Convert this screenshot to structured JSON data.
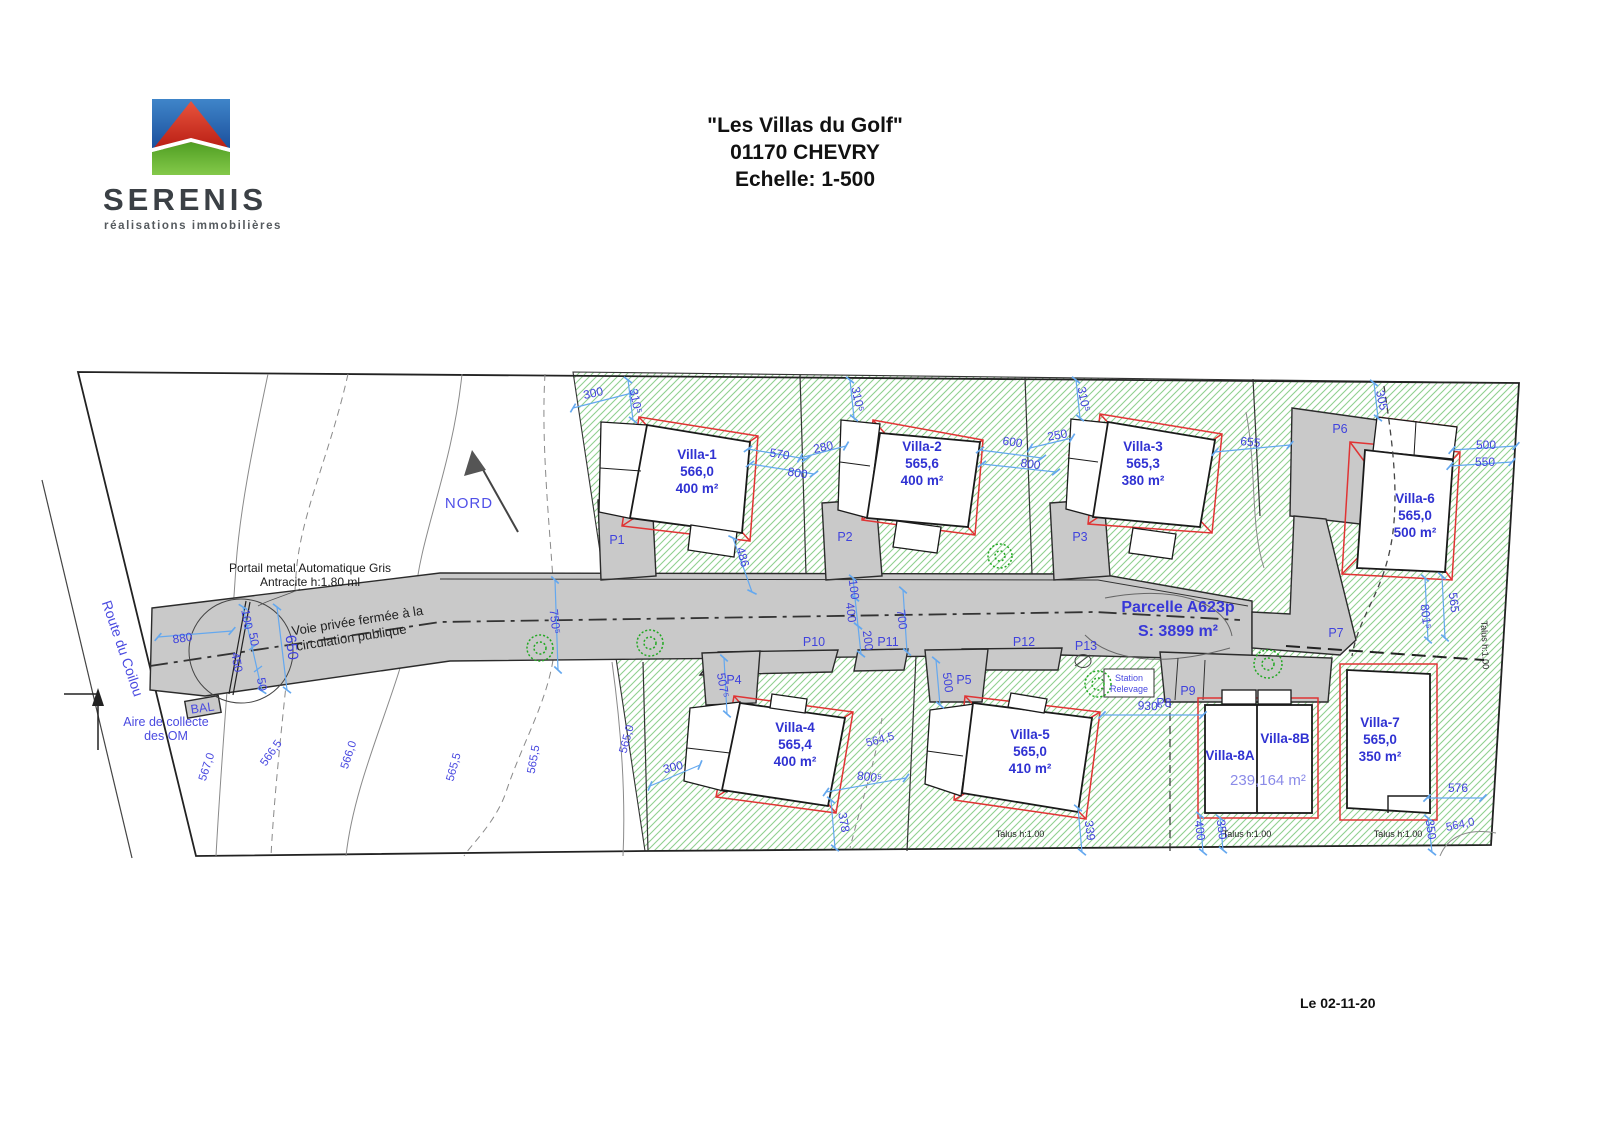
{
  "colors": {
    "accent_blue": "#3c3cdc",
    "dim_blue": "#64a8ef",
    "villa_red": "#e03434",
    "hatch_green": "#90d090",
    "road_gray": "#c9c9c9",
    "logo_blue": "#2a6db5",
    "logo_red": "#d42f23",
    "logo_green": "#6ab12f"
  },
  "header": {
    "brand": "SERENIS",
    "tagline": "réalisations immobilières",
    "title": "\"Les Villas du Golf\"",
    "subtitle": "01170 CHEVRY",
    "scale": "Echelle: 1-500"
  },
  "plan": {
    "north": "NORD",
    "route": "Route du Coilou",
    "gate1": "Portail metal Automatique Gris",
    "gate2": "Antracite h:1.80 ml",
    "voie1": "Voie privée fermée à la",
    "voie2": "circulation publique",
    "om1": "Aire de collecte",
    "om2": "des OM",
    "bal": "BAL",
    "parcel1": "Parcelle A623p",
    "parcel2": "S: 3899 m²",
    "station1": "Station",
    "station2": "Relevage",
    "talus": "Talus h:1.00",
    "date": "Le 02-11-20",
    "villa8_area": "239,164 m²"
  },
  "villas": [
    {
      "name": "Villa-1",
      "level": "566,0",
      "area": "400 m²"
    },
    {
      "name": "Villa-2",
      "level": "565,6",
      "area": "400 m²"
    },
    {
      "name": "Villa-3",
      "level": "565,3",
      "area": "380 m²"
    },
    {
      "name": "Villa-4",
      "level": "565,4",
      "area": "400 m²"
    },
    {
      "name": "Villa-5",
      "level": "565,0",
      "area": "410 m²"
    },
    {
      "name": "Villa-6",
      "level": "565,0",
      "area": "500 m²"
    },
    {
      "name": "Villa-7",
      "level": "565,0",
      "area": "350 m²"
    },
    {
      "name": "Villa-8A",
      "level": "",
      "area": ""
    },
    {
      "name": "Villa-8B",
      "level": "",
      "area": ""
    }
  ],
  "parkings": [
    "P1",
    "P2",
    "P3",
    "P4",
    "P5",
    "P6",
    "P7",
    "P8",
    "P9",
    "P10",
    "P11",
    "P12",
    "P13"
  ],
  "dims": [
    "300",
    "310⁵",
    "570",
    "800",
    "280",
    "310⁵",
    "600",
    "800",
    "250",
    "310⁵",
    "655",
    "305",
    "500",
    "550",
    "486",
    "750⁵",
    "100",
    "400",
    "200",
    "700",
    "507⁵",
    "300",
    "800⁵",
    "378",
    "500",
    "339",
    "930⁵",
    "400",
    "350",
    "350",
    "576",
    "801⁵",
    "565",
    "880",
    "100",
    "50",
    "450",
    "50",
    "650"
  ],
  "contours": [
    "567,0",
    "566,5",
    "566,0",
    "565,5",
    "565,0",
    "564,5",
    "564,0"
  ]
}
